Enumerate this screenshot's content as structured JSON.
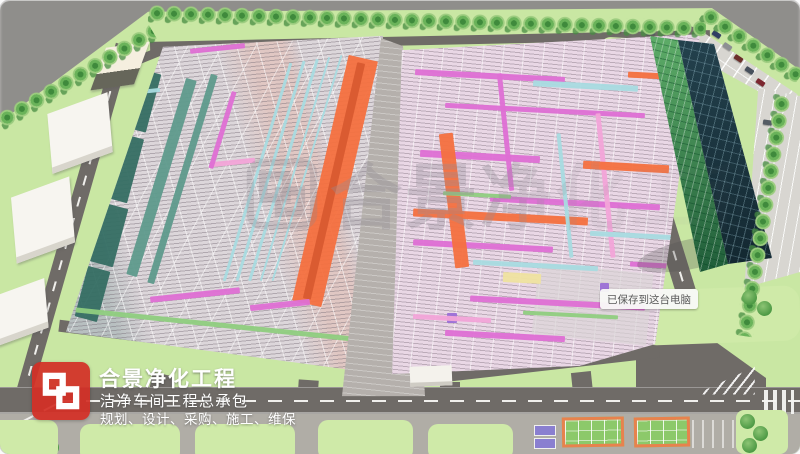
{
  "branding": {
    "logo": "hejing-h-monogram",
    "company_name": "合景净化工程",
    "tagline": "洁净车间工程总承包",
    "services": "规划、设计、采购、施工、维保"
  },
  "watermark": {
    "logo": "hejing-h-monogram-watermark",
    "text": "合景净化工程"
  },
  "tooltip": {
    "text": "已保存到这台电脑"
  },
  "colors": {
    "brand_red": "#d2352b",
    "outside_gray": "#8f8e8b",
    "site_green": "#c9e7a3",
    "road_gray": "#6f6b67",
    "apron_gray": "#b0ada6",
    "parking_gray": "#d8d6d1",
    "hall_left_base": "#dcd6da",
    "hall_right_base": "#eae3e7",
    "glass_dark": "#1c3943",
    "glass_green": "#2f7d49",
    "pipe_teal": "#356e63",
    "pipe_teal_light": "#5e9a8c",
    "pipe_cyan": "#a8dbe0",
    "pipe_orange": "#f4703f",
    "pipe_orange_dark": "#d85a30",
    "pipe_magenta": "#de6fd4",
    "pipe_pink": "#f2a4d8",
    "pipe_purple": "#9b6fd6",
    "pipe_green": "#8fce7f",
    "pipe_yellow": "#efe3a0",
    "court_orange": "#e8824d",
    "court_green": "#8cc96a",
    "badge_bg": "#f8f8f6",
    "badge_text": "#595959",
    "text_white": "#ffffff"
  },
  "scene": {
    "landmark_labels": [
      "left-production-hall",
      "right-production-hall",
      "office-glass-tower",
      "utility-building",
      "warehouse-box",
      "parking-lot",
      "tree-row",
      "perimeter-road",
      "sports-court",
      "crosswalk",
      "chevron-island",
      "gatehouse"
    ],
    "left_hall": {
      "name": "left-production-hall",
      "pipes": [
        {
          "x": 66,
          "y": 40,
          "w": 28,
          "h": 60,
          "r": 15,
          "c": "pipe_teal"
        },
        {
          "x": 50,
          "y": 105,
          "w": 26,
          "h": 66,
          "r": 15,
          "c": "pipe_teal"
        },
        {
          "x": 36,
          "y": 175,
          "w": 25,
          "h": 60,
          "r": 15,
          "c": "pipe_teal"
        },
        {
          "x": 21,
          "y": 238,
          "w": 23,
          "h": 52,
          "r": 15,
          "c": "pipe_teal"
        },
        {
          "x": 96,
          "y": 45,
          "w": 11,
          "h": 205,
          "r": 17,
          "c": "pipe_teal_light"
        },
        {
          "x": 119,
          "y": 40,
          "w": 7,
          "h": 218,
          "r": 17,
          "c": "pipe_teal_light"
        },
        {
          "x": 196,
          "y": 28,
          "w": 3,
          "h": 228,
          "r": 17,
          "c": "pipe_cyan"
        },
        {
          "x": 209,
          "y": 26,
          "w": 3,
          "h": 230,
          "r": 17,
          "c": "pipe_cyan"
        },
        {
          "x": 222,
          "y": 24,
          "w": 3,
          "h": 232,
          "r": 17,
          "c": "pipe_cyan"
        },
        {
          "x": 234,
          "y": 22,
          "w": 2,
          "h": 234,
          "r": 17,
          "c": "pipe_cyan"
        },
        {
          "x": 246,
          "y": 20,
          "w": 2,
          "h": 236,
          "r": 17,
          "c": "pipe_cyan"
        },
        {
          "x": 260,
          "y": 25,
          "w": 30,
          "h": 252,
          "r": 13,
          "c": "pipe_orange"
        },
        {
          "x": 270,
          "y": 30,
          "w": 8,
          "h": 242,
          "r": 13,
          "c": "pipe_orange_dark"
        },
        {
          "x": 130,
          "y": 16,
          "w": 55,
          "h": 5,
          "r": -6,
          "c": "pipe_magenta"
        },
        {
          "x": 95,
          "y": 8,
          "w": 40,
          "h": 5,
          "r": -6,
          "c": "pipe_pink"
        },
        {
          "x": 150,
          "y": 130,
          "w": 45,
          "h": 5,
          "r": -6,
          "c": "pipe_pink"
        },
        {
          "x": 90,
          "y": 262,
          "w": 90,
          "h": 6,
          "r": -6,
          "c": "pipe_magenta"
        },
        {
          "x": 190,
          "y": 272,
          "w": 60,
          "h": 6,
          "r": -6,
          "c": "pipe_magenta"
        },
        {
          "x": 15,
          "y": 292,
          "w": 280,
          "h": 5,
          "r": 6,
          "c": "pipe_green"
        },
        {
          "x": 160,
          "y": 60,
          "w": 5,
          "h": 80,
          "r": 17,
          "c": "pipe_magenta"
        },
        {
          "x": 60,
          "y": 60,
          "w": 40,
          "h": 4,
          "r": -6,
          "c": "pipe_cyan"
        }
      ]
    },
    "right_hall": {
      "name": "right-production-hall",
      "pipes": [
        {
          "x": 30,
          "y": 45,
          "w": 150,
          "h": 6,
          "r": 3,
          "c": "pipe_magenta"
        },
        {
          "x": 60,
          "y": 80,
          "w": 200,
          "h": 5,
          "r": 3,
          "c": "pipe_magenta"
        },
        {
          "x": 35,
          "y": 125,
          "w": 120,
          "h": 7,
          "r": 3,
          "c": "pipe_magenta"
        },
        {
          "x": 105,
          "y": 172,
          "w": 170,
          "h": 6,
          "r": 3,
          "c": "pipe_magenta"
        },
        {
          "x": 28,
          "y": 215,
          "w": 140,
          "h": 6,
          "r": 3,
          "c": "pipe_magenta"
        },
        {
          "x": 150,
          "y": 240,
          "w": 115,
          "h": 72,
          "r": 6,
          "c": "rgba(219,213,214,0.75)"
        },
        {
          "x": 85,
          "y": 272,
          "w": 175,
          "h": 6,
          "r": 3,
          "c": "pipe_magenta"
        },
        {
          "x": 60,
          "y": 305,
          "w": 120,
          "h": 6,
          "r": 3,
          "c": "pipe_magenta"
        },
        {
          "x": 118,
          "y": 45,
          "w": 5,
          "h": 118,
          "r": -6,
          "c": "pipe_magenta"
        },
        {
          "x": 218,
          "y": 85,
          "w": 5,
          "h": 145,
          "r": -6,
          "c": "pipe_pink"
        },
        {
          "x": 62,
          "y": 105,
          "w": 14,
          "h": 135,
          "r": -7,
          "c": "pipe_orange"
        },
        {
          "x": 28,
          "y": 185,
          "w": 175,
          "h": 8,
          "r": 3,
          "c": "pipe_orange"
        },
        {
          "x": 198,
          "y": 135,
          "w": 86,
          "h": 8,
          "r": 3,
          "c": "pipe_orange"
        },
        {
          "x": 243,
          "y": 45,
          "w": 56,
          "h": 6,
          "r": 3,
          "c": "pipe_orange"
        },
        {
          "x": 148,
          "y": 55,
          "w": 105,
          "h": 6,
          "r": 3,
          "c": "pipe_cyan"
        },
        {
          "x": 88,
          "y": 235,
          "w": 125,
          "h": 5,
          "r": 3,
          "c": "pipe_cyan"
        },
        {
          "x": 205,
          "y": 205,
          "w": 85,
          "h": 5,
          "r": 3,
          "c": "pipe_cyan"
        },
        {
          "x": 178,
          "y": 105,
          "w": 4,
          "h": 125,
          "r": -6,
          "c": "pipe_cyan"
        },
        {
          "x": 58,
          "y": 165,
          "w": 68,
          "h": 4,
          "r": 3,
          "c": "pipe_green"
        },
        {
          "x": 138,
          "y": 285,
          "w": 95,
          "h": 4,
          "r": 3,
          "c": "pipe_green"
        },
        {
          "x": 118,
          "y": 245,
          "w": 38,
          "h": 10,
          "r": 3,
          "c": "pipe_yellow"
        },
        {
          "x": 62,
          "y": 285,
          "w": 10,
          "h": 10,
          "r": 0,
          "c": "pipe_purple"
        },
        {
          "x": 215,
          "y": 255,
          "w": 9,
          "h": 9,
          "r": 0,
          "c": "pipe_purple"
        },
        {
          "x": 28,
          "y": 288,
          "w": 78,
          "h": 5,
          "r": 3,
          "c": "pipe_pink"
        },
        {
          "x": 245,
          "y": 235,
          "w": 58,
          "h": 5,
          "r": 3,
          "c": "pipe_magenta"
        }
      ]
    }
  }
}
